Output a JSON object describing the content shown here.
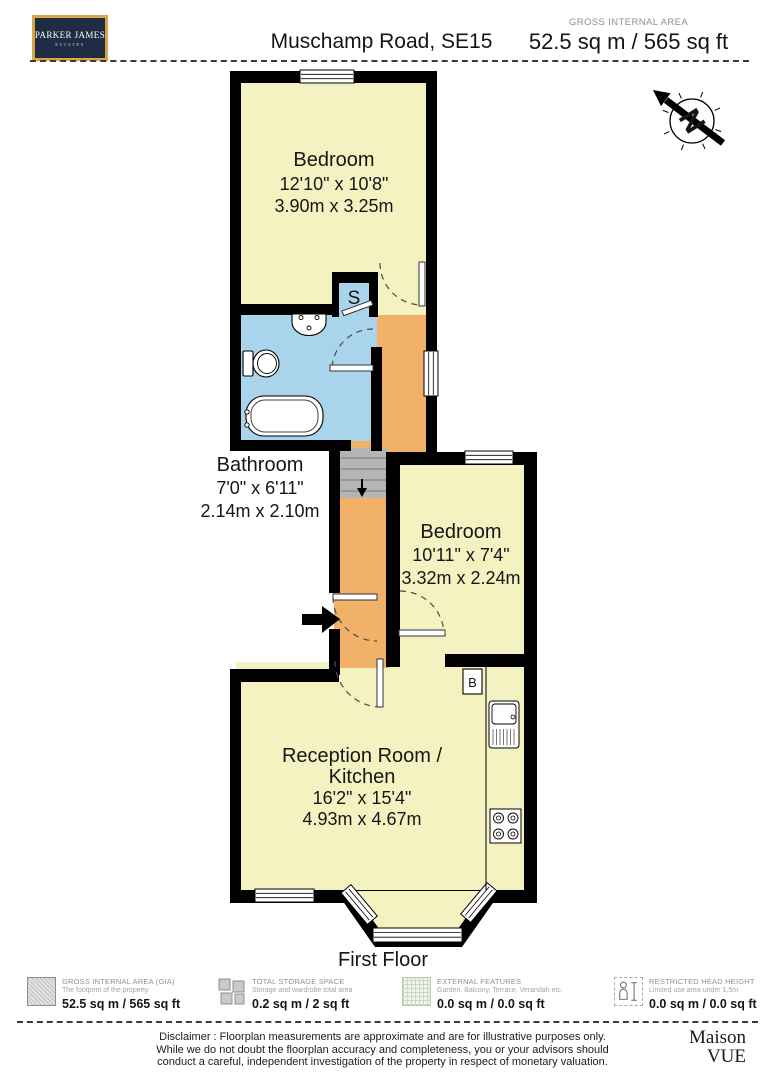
{
  "header": {
    "logo_line1": "PARKER JAMES",
    "logo_line2": "ESTATES",
    "title": "Muschamp Road, SE15",
    "gia_label": "GROSS INTERNAL AREA",
    "gia_value": "52.5 sq m / 565 sq ft"
  },
  "floorplan": {
    "floor_label": "First Floor",
    "north_label": "N",
    "markers": {
      "storage": "S",
      "boiler": "B"
    },
    "rooms": {
      "bedroom1": {
        "name": "Bedroom",
        "imperial": "12'10\" x 10'8\"",
        "metric": "3.90m x 3.25m"
      },
      "bathroom": {
        "name": "Bathroom",
        "imperial": "7'0\" x 6'11\"",
        "metric": "2.14m x 2.10m"
      },
      "bedroom2": {
        "name": "Bedroom",
        "imperial": "10'11\" x 7'4\"",
        "metric": "3.32m x 2.24m"
      },
      "reception": {
        "name_line1": "Reception Room /",
        "name_line2": "Kitchen",
        "imperial": "16'2\" x 15'4\"",
        "metric": "4.93m x 4.67m"
      }
    }
  },
  "legend": {
    "items": [
      {
        "icon": "hatched-square",
        "title": "GROSS INTERNAL AREA (GIA)",
        "subtitle": "The footprint of the property",
        "value": "52.5 sq m / 565 sq ft"
      },
      {
        "icon": "storage-blocks",
        "title": "TOTAL STORAGE SPACE",
        "subtitle": "Storage and wardrobe total area",
        "value": "0.2 sq m / 2 sq ft"
      },
      {
        "icon": "grid-square",
        "title": "EXTERNAL FEATURES",
        "subtitle": "Garden, Balcony, Terrace, Verandah etc.",
        "value": "0.0 sq m / 0.0 sq ft"
      },
      {
        "icon": "person-height",
        "title": "RESTRICTED HEAD HEIGHT",
        "subtitle": "Limited use area under 1.5m",
        "value": "0.0 sq m / 0.0 sq ft"
      }
    ]
  },
  "footer": {
    "disclaimer_line1": "Disclaimer : Floorplan measurements are approximate and are for illustrative purposes only.",
    "disclaimer_line2": "While we do not doubt the floorplan accuracy and completeness, you or your advisors should",
    "disclaimer_line3": "conduct a careful, independent investigation of the property in respect of monetary valuation.",
    "brand_line1": "Maison",
    "brand_line2": "VUE"
  },
  "colors": {
    "room_fill": "#f5f2c2",
    "bathroom_fill": "#a9d4ec",
    "hallway_fill": "#f2b169",
    "stairs_fill": "#b5b5b5",
    "wall": "#000000",
    "logo_bg": "#1e2d44",
    "logo_border": "#d8a644"
  }
}
